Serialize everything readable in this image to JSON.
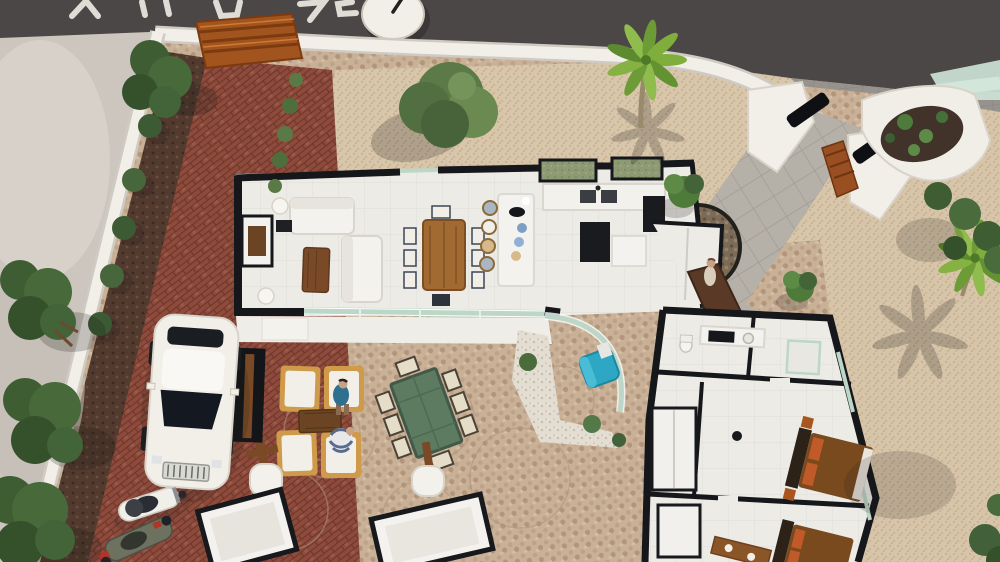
{
  "meta": {
    "title": "Aerial 3D cutaway render of a single-storey villa floor plan with landscaped plot"
  },
  "palette": {
    "road": "#4b4747",
    "road_marking": "#ece9e2",
    "sidewalk": "#96938e",
    "neighbor_lot": "#cdc6bf",
    "wall_white": "#f2efe9",
    "wall_cut_black": "#15171b",
    "brick_paving": "#8e4b3b",
    "gravel_beige": "#d8c6ab",
    "cobble_tan": "#c9b197",
    "white_gravel": "#e3ddd2",
    "mulch": "#523a2e",
    "floor_white": "#edebe6",
    "glass_green": "#bcd6c8",
    "wood": "#7a4a26",
    "corten_rust": "#9a4f22",
    "table_green": "#5c7b61",
    "chair_blue": "#2ea7c4",
    "bed_brown": "#7a4a1f",
    "pillow_orange": "#c05a28",
    "car_white": "#f2efe8",
    "palm_green": "#7fae3c",
    "shrub_green": "#44613a"
  },
  "scene": {
    "road": {
      "label": "asphalt road with cropped white painted marking (illegible) and round white clock-like disc",
      "marking_legible": false
    },
    "perimeter": {
      "label": "white boundary walls with corten steel gate panels and black-capped curved entry pillars"
    },
    "garden": {
      "label": "beige gravel garden with olive tree, two top-view palm trees with star shadows, shrub rows on dark mulch, cactus planter"
    },
    "house": {
      "label": "white cutaway villa, walls shown as black plan-cut lines",
      "rooms": [
        {
          "name": "living-room",
          "furniture": "two white sofas, wooden coffee table, TV sideboard, sphere floor lamps"
        },
        {
          "name": "dining-area",
          "furniture": "wooden table with eight chairs"
        },
        {
          "name": "kitchen",
          "furniture": "white island breakfast bar with four stools, double sink counter, black tall cabinets, pantry"
        },
        {
          "name": "entrance-hall",
          "furniture": "brown pivot front door, circular pebble courtyard"
        },
        {
          "name": "bathroom",
          "furniture": "vanity with black sink, toilet, shower"
        },
        {
          "name": "bedroom-1",
          "furniture": "brown double bed, dark headboard, orange pillows, wardrobes"
        },
        {
          "name": "bedroom-2",
          "furniture": "brown double bed partially cropped at bottom edge"
        }
      ]
    },
    "terrace": {
      "label": "white terrace with green-tinted sliding glass doors and curved glass wall around blue armchair"
    },
    "patio": {
      "label": "circular-pattern cobblestone patio",
      "lounge_chairs": 4,
      "outdoor_dining_chairs": 8,
      "planter_posts": 2
    },
    "people": [
      {
        "name": "person-sitting-blue-shirt",
        "location": "lounge chair"
      },
      {
        "name": "person-striped-top",
        "location": "lounge chair"
      },
      {
        "name": "person-standing",
        "location": "house entrance"
      }
    ],
    "vehicles": {
      "car": "white luxury sedan parked on red brick drive",
      "scooters": 2
    }
  }
}
